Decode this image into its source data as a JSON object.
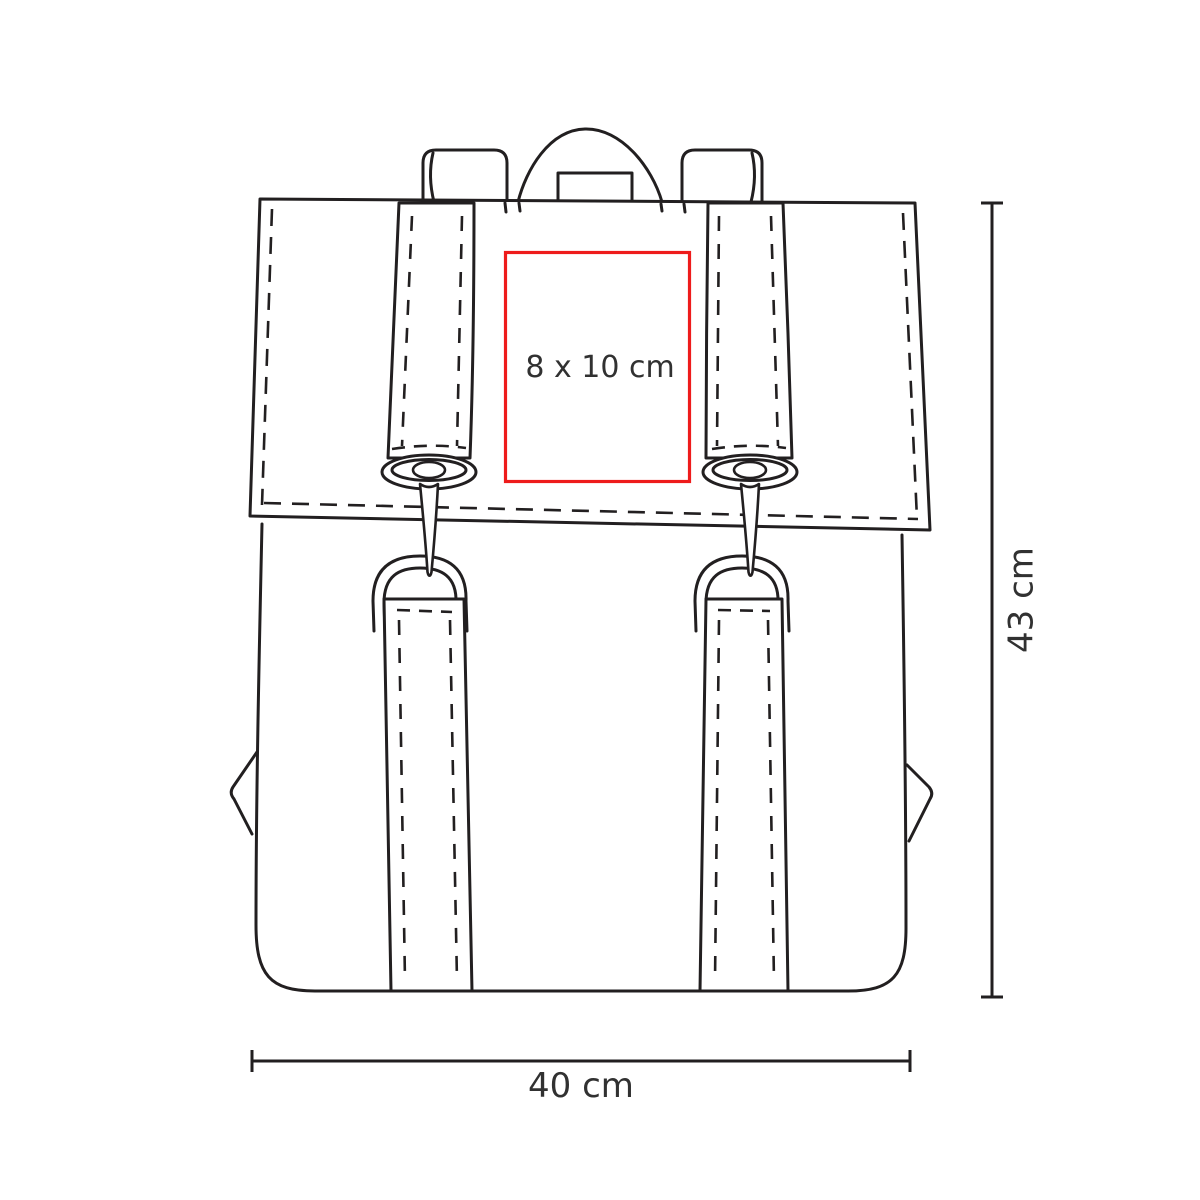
{
  "diagram": {
    "kind": "product imprint-area template",
    "product": "backpack (front view line art)",
    "print_area": {
      "label": "8 x 10 cm"
    },
    "dimensions": {
      "height": {
        "label": "43 cm"
      },
      "width": {
        "label": "40 cm"
      }
    }
  },
  "colors": {
    "line": "#221f20",
    "red": "#ee1b1b",
    "text": "#313131",
    "bg": "#ffffff"
  }
}
